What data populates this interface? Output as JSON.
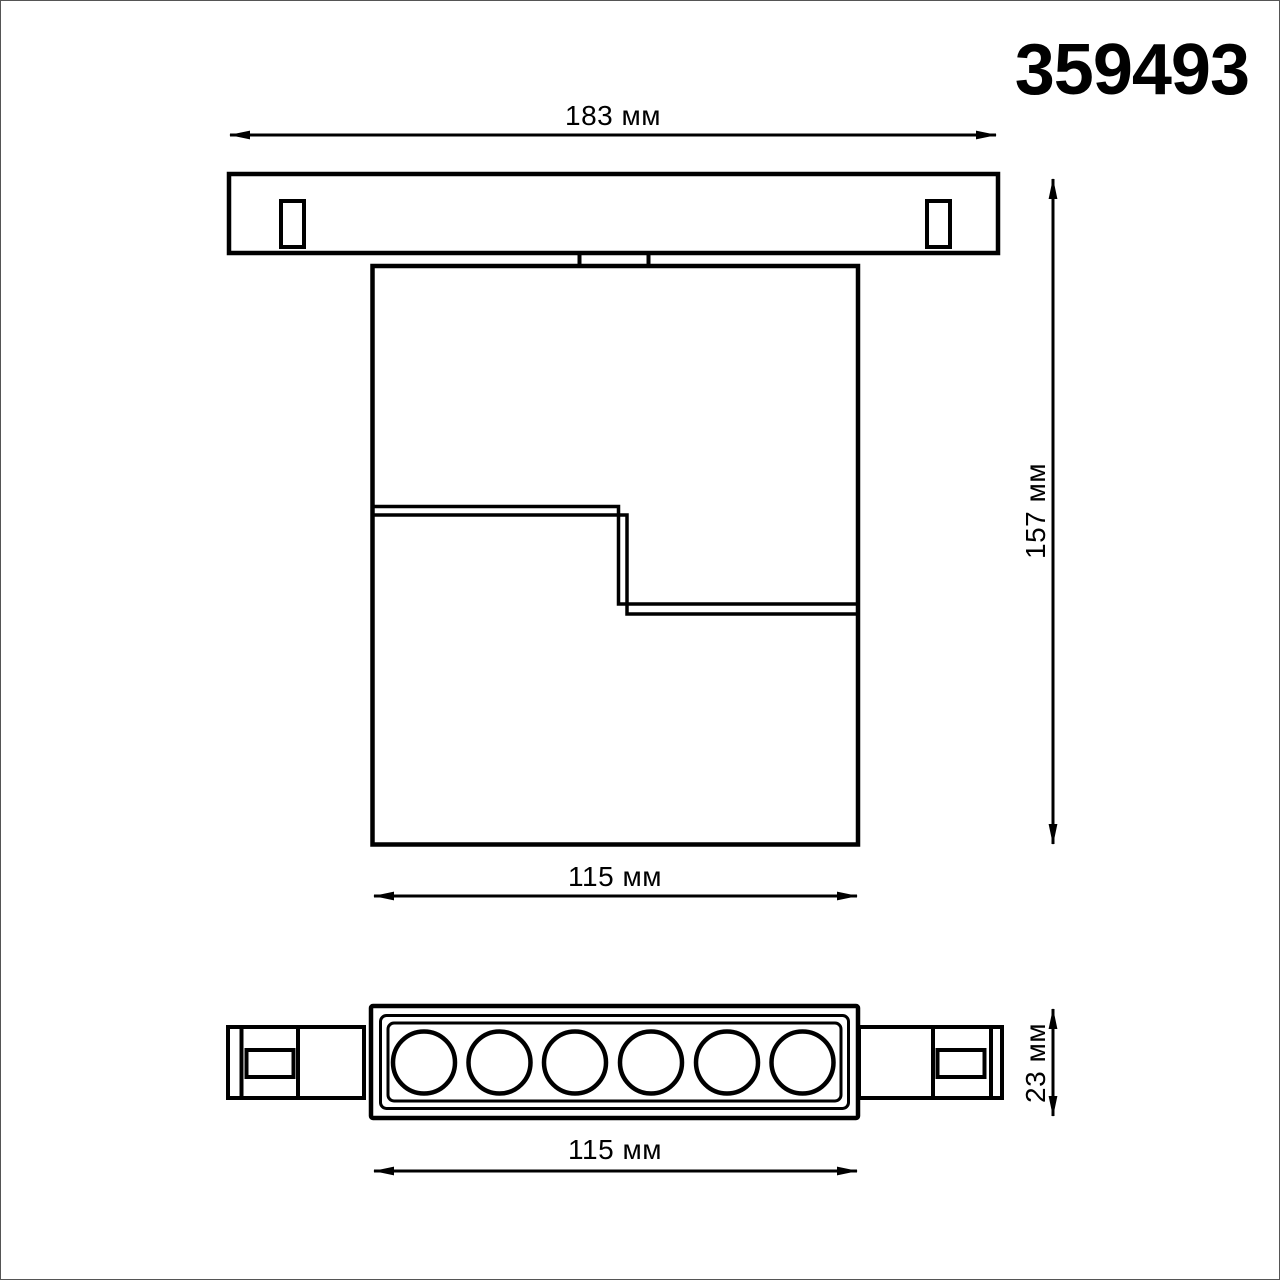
{
  "title": "359493",
  "drawing": {
    "background": "#ffffff",
    "line_color": "#000000",
    "units": "мм",
    "led_count": 6,
    "dimensions": {
      "track_width": "183 мм",
      "overall_height": "157 мм",
      "body_width": "115 мм",
      "head_width": "115 мм",
      "head_depth": "23 мм"
    }
  }
}
